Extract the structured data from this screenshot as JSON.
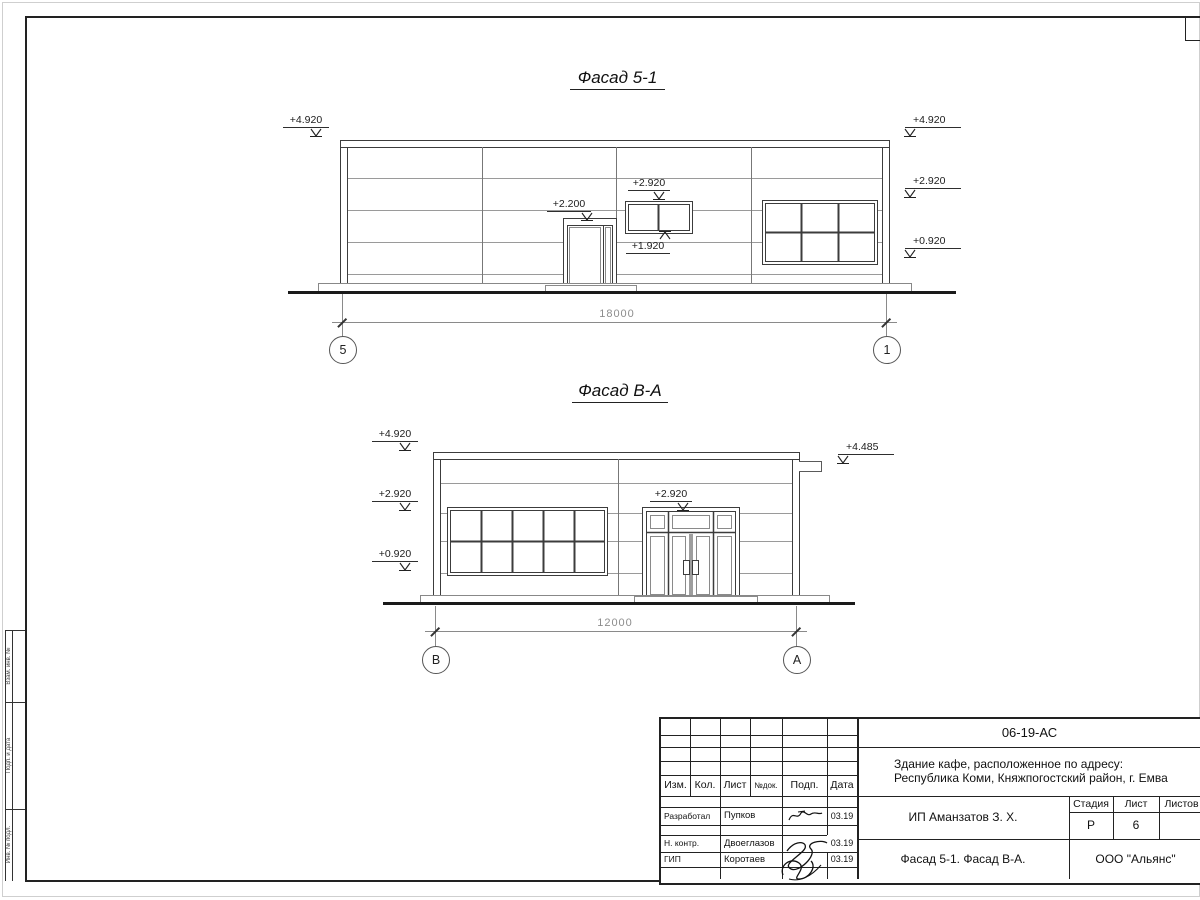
{
  "facade1": {
    "title": "Фасад 5-1",
    "dimension": "18000",
    "axis_left": "5",
    "axis_right": "1",
    "marks": {
      "left_top": "+4.920",
      "right_top": "+4.920",
      "right_mid": "+2.920",
      "right_low": "+0.920",
      "door": "+2.200",
      "window_top": "+2.920",
      "window_bottom": "+1.920"
    }
  },
  "facade2": {
    "title": "Фасад В-А",
    "dimension": "12000",
    "axis_left": "В",
    "axis_right": "А",
    "marks": {
      "left_top": "+4.920",
      "left_mid": "+2.920",
      "left_low": "+0.920",
      "door": "+2.920",
      "right_top": "+4.485"
    }
  },
  "title_block": {
    "doc_code": "06-19-АС",
    "project_address_line1": "Здание кафе, расположенное по адресу:",
    "project_address_line2": "Республика Коми, Княжпогостский район, г. Емва",
    "client": "ИП Аманзатов З. Х.",
    "sheet_name": "Фасад 5-1. Фасад В-А.",
    "organization": "ООО \"Альянс\"",
    "columns": [
      "Изм.",
      "Кол.",
      "Лист",
      "№док.",
      "Подп.",
      "Дата"
    ],
    "stage_label": "Стадия",
    "sheet_label": "Лист",
    "sheets_label": "Листов",
    "stage_value": "Р",
    "sheet_value": "6",
    "sheets_value": "",
    "signers": [
      {
        "role": "Разработал",
        "name": "Пупков",
        "date": "03.19"
      },
      {
        "role": "Н. контр.",
        "name": "Двоеглазов",
        "date": "03.19"
      },
      {
        "role": "ГИП",
        "name": "Коротаев",
        "date": "03.19"
      }
    ]
  },
  "margin_stamps": {
    "s1": "Взам. инв. №",
    "s2": "Подп. и дата",
    "s3": "Инв. № подл."
  }
}
